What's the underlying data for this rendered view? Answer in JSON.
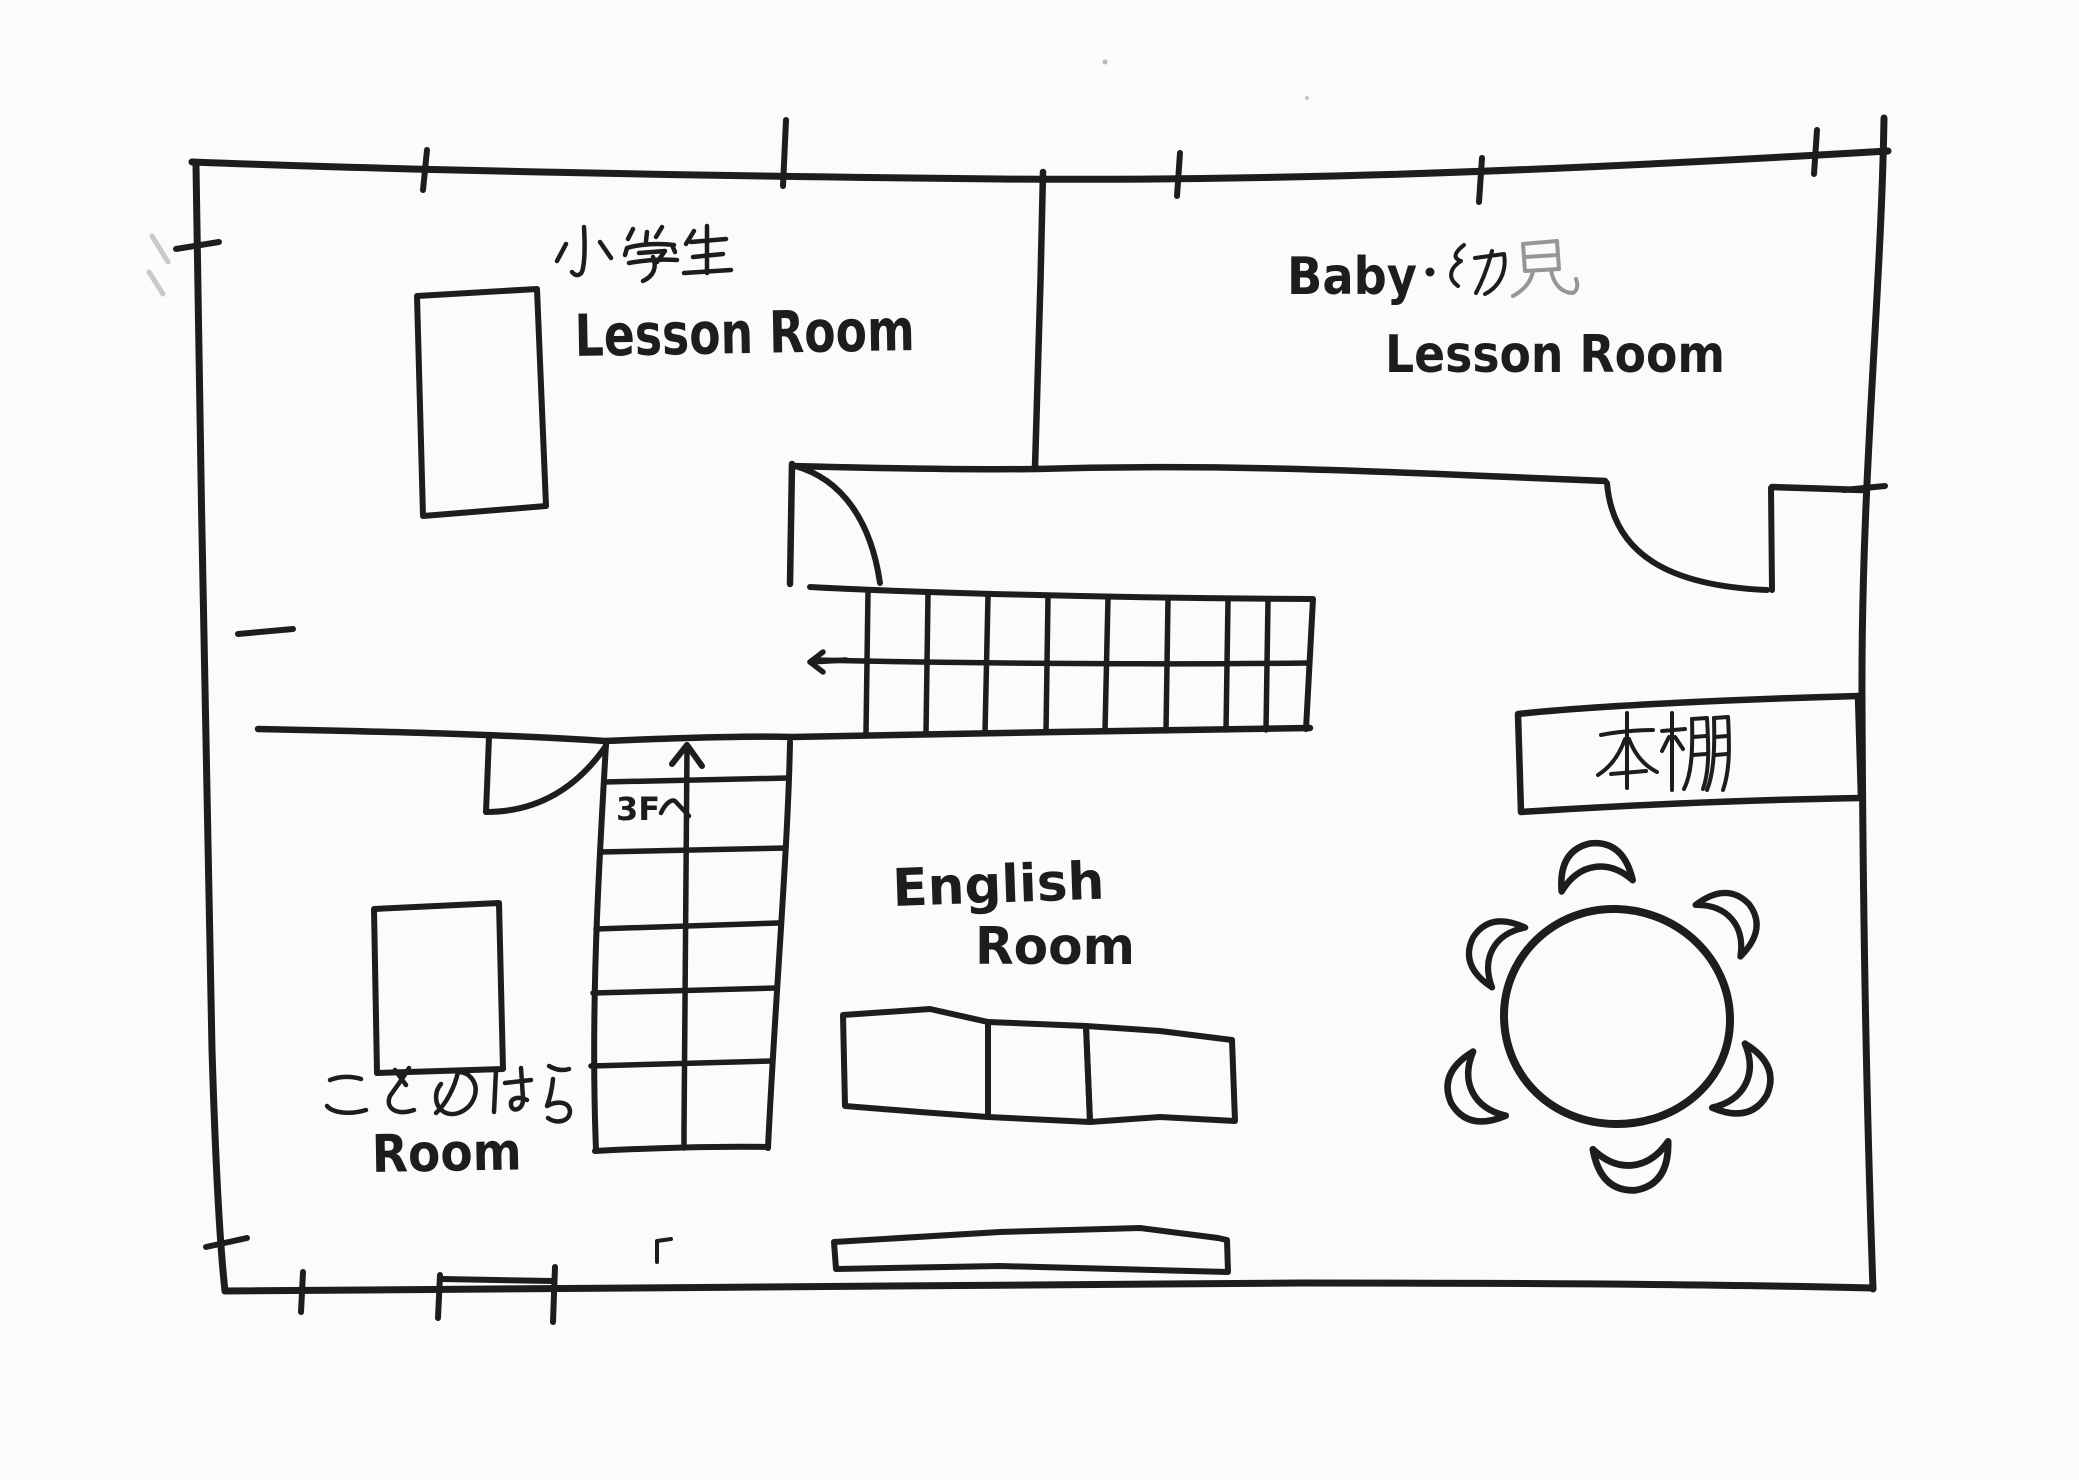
{
  "plan": {
    "kind": "hand-drawn floor plan sketch",
    "colors": {
      "ink": "#1d1d1f",
      "pencil": "#96969a",
      "paper": "#fbfbf9"
    },
    "rooms": {
      "elementary": {
        "name_ja": "小学生",
        "name_en": "Lesson Room"
      },
      "baby": {
        "name_en": "Baby",
        "separator": "・",
        "name_ja": "幼児",
        "room_en": "Lesson Room"
      },
      "english": {
        "line1": "English",
        "line2": "Room"
      },
      "kotonohara": {
        "name_ja": "ことのはら",
        "name_en": "Room"
      }
    },
    "stairs": {
      "to_3f_latin": "3F",
      "to_3f_ja": "へ",
      "to_3f_full": "3Fへ",
      "up_arrow": "↑",
      "left_arrow": "←",
      "upper_flight_treads": 8,
      "to_3f_flight_treads": 6
    },
    "furniture": {
      "bookshelf_ja": "本棚",
      "round_table_chairs": 6,
      "segmented_table_sections": 3,
      "desks": 2,
      "low_board": 1,
      "doors": 3
    }
  }
}
